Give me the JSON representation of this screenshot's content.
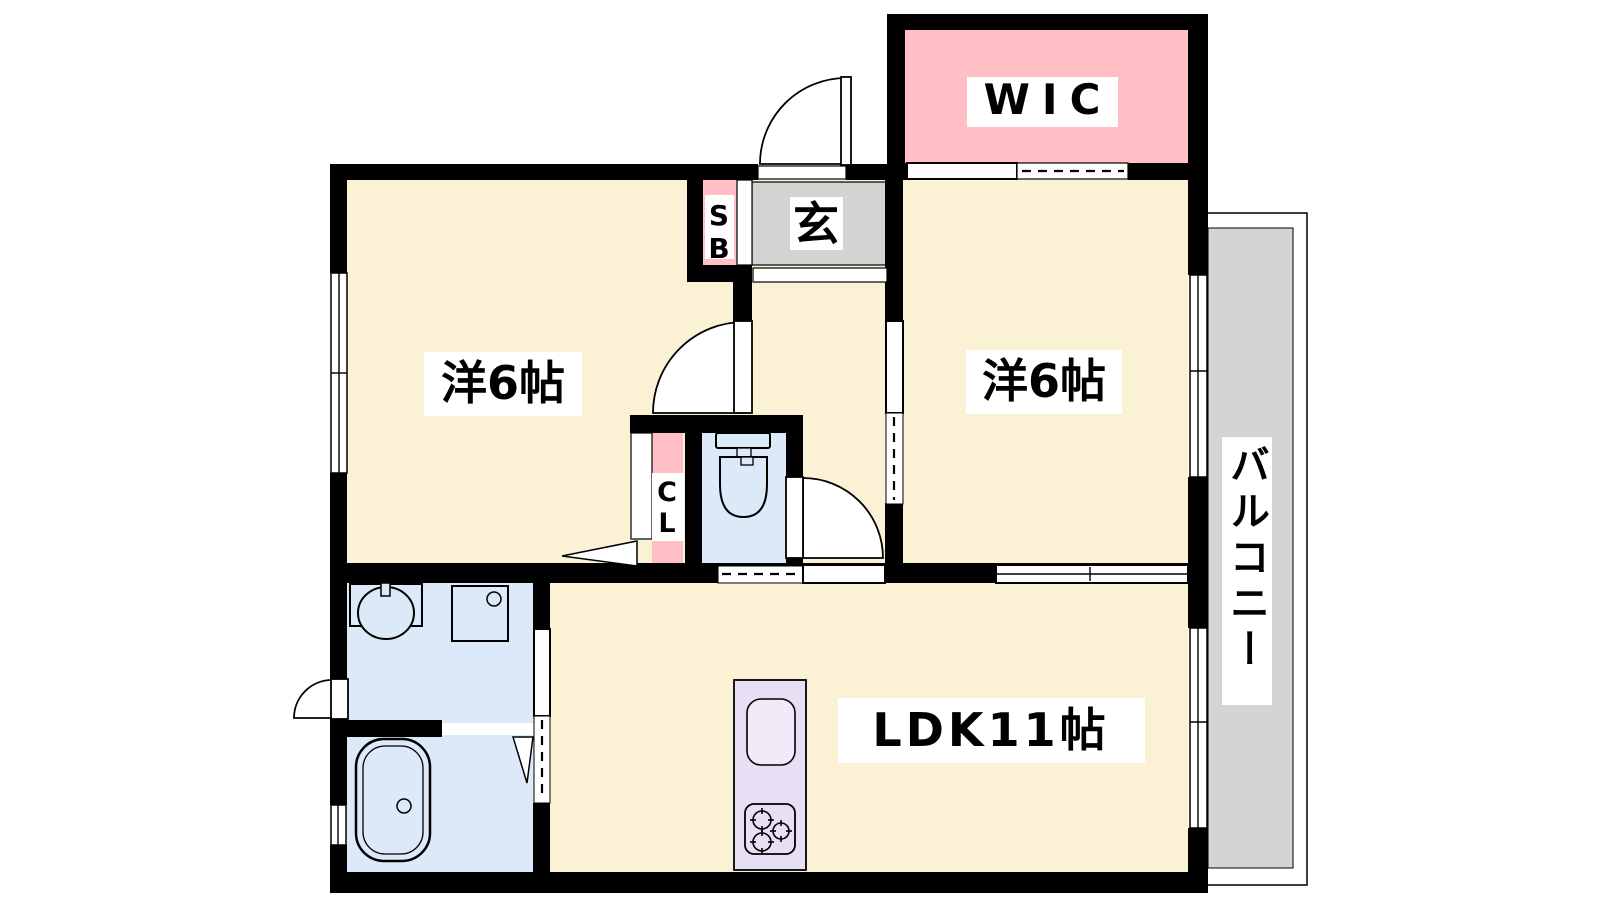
{
  "title": "apartment-floor-plan",
  "labels": {
    "wic": "WIC",
    "entrance": "玄",
    "shoe_box": "SB",
    "room_left": "洋6帖",
    "room_right": "洋6帖",
    "closet": "CL",
    "ldk": "LDK11帖",
    "balcony": "バルコニー"
  },
  "colors": {
    "wall": "#000000",
    "room_cream": "#FBF1D5",
    "accent_pink": "#FFBFC4",
    "entrance_gray": "#D3D3D3",
    "balcony_gray": "#D4D4D4",
    "sanitary_blue": "#DCE9F8",
    "kitchen_purple": "#E7DFF4",
    "sink_fill": "#F0EAF9",
    "outline_white": "#FFFFFF"
  },
  "fixtures": [
    "toilet",
    "washbasin",
    "washing-machine-pan",
    "bathtub",
    "kitchen-sink",
    "stove-3-burner"
  ],
  "door_symbols": [
    "hinged-door-swing",
    "single-sliding-door",
    "double-sliding-door",
    "folding-door",
    "window"
  ]
}
